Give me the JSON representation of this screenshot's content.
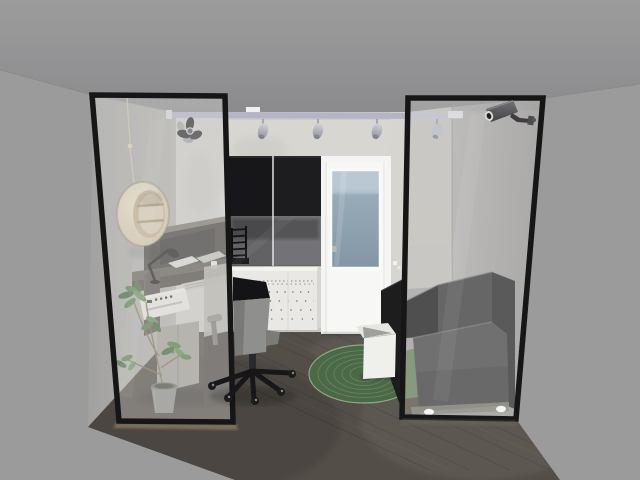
{
  "scene": {
    "description": "3D rendered room preview: home office with glass partition walls seen head-on, gray void surround",
    "objects": [
      {
        "id": "glass-partition-left",
        "label": "Glass partition panel (left)"
      },
      {
        "id": "glass-partition-right",
        "label": "Glass partition panel (right)"
      },
      {
        "id": "security-camera",
        "label": "CCTV security camera"
      },
      {
        "id": "track-light",
        "label": "Ceiling track light with spotlights"
      },
      {
        "id": "dark-spotlight-cluster",
        "label": "Dark multi-head spotlight"
      },
      {
        "id": "round-wall-shelf",
        "label": "Round wooden wall shelf on cord"
      },
      {
        "id": "wall-cabinet",
        "label": "Black wall cabinet with glass doors"
      },
      {
        "id": "drawer-unit",
        "label": "White drawer unit"
      },
      {
        "id": "balcony-door",
        "label": "White balcony door with glass"
      },
      {
        "id": "wall-socket",
        "label": "Wall socket"
      },
      {
        "id": "corner-desk",
        "label": "Dark corner desk with hutch"
      },
      {
        "id": "desk-lamp",
        "label": "Black desk lamp"
      },
      {
        "id": "keyboard",
        "label": "Keyboard"
      },
      {
        "id": "printer",
        "label": "White printer"
      },
      {
        "id": "office-chair",
        "label": "Office swivel chair"
      },
      {
        "id": "potted-plant",
        "label": "Potted plant"
      },
      {
        "id": "oval-rug",
        "label": "Green oval rug"
      },
      {
        "id": "storage-box",
        "label": "White storage box"
      },
      {
        "id": "sofa",
        "label": "Black sofa"
      },
      {
        "id": "wood-floor",
        "label": "Dark wood plank floor"
      }
    ]
  },
  "colors": {
    "void": "#9b9b9b",
    "ceiling": "#8f8f91",
    "wall": "#d7d6d1",
    "frame": "#161616",
    "floor": "#534e48",
    "track": "#b4b4c6",
    "cabinet": "#1d1d1f",
    "cabinet_glass": "#626265",
    "drawers": "#e9e8e5",
    "door": "#f4f4f2",
    "door_glass_sky": "#b9c8d3",
    "door_glass": "#8da0ae",
    "rug": "#4b6847",
    "rug_ring": "#7e9a74",
    "rug_tinted": "#879a7d",
    "box": "#efefec",
    "sofa_black": "#1d1d1e",
    "sofa_gray": "#666666",
    "sofa_seat": "#707070",
    "chair_dark": "#141416",
    "chair_gray": "#8f8f8d",
    "shelf_inner": "#c3b08f",
    "pot": "#8b8a86",
    "printer": "#eceae6",
    "keyboard": "#c8c7c2",
    "plant": "#4d7a41",
    "plant_dark": "#3a6331",
    "desk": "#413d39",
    "desk_top": "#5e5952",
    "camera": "#3e3e40",
    "lamp": "#151517"
  }
}
